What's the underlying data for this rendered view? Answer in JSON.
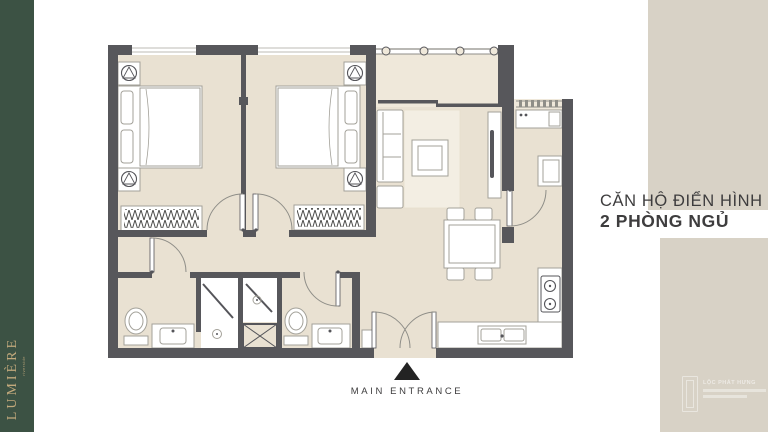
{
  "brand": {
    "name": "LUMIÈRE",
    "tagline": "riverside"
  },
  "title": {
    "line1": "CĂN HỘ ĐIỂN HÌNH",
    "line2": "2 PHÒNG NGỦ"
  },
  "entrance": {
    "label": "MAIN ENTRANCE"
  },
  "watermark": {
    "line1": "LỘC PHÁT HƯNG"
  },
  "colors": {
    "green": "#3c5244",
    "gold": "#c2a97c",
    "panel": "#d8d2c6",
    "ink": "#3e3d3e",
    "wall": "#57575b",
    "floor": "#e9e1d2",
    "floor2": "#efe8da",
    "rug": "#f3eee3",
    "furn": "#a3a199",
    "detail": "#55555a",
    "arc": "#8f8e88"
  }
}
